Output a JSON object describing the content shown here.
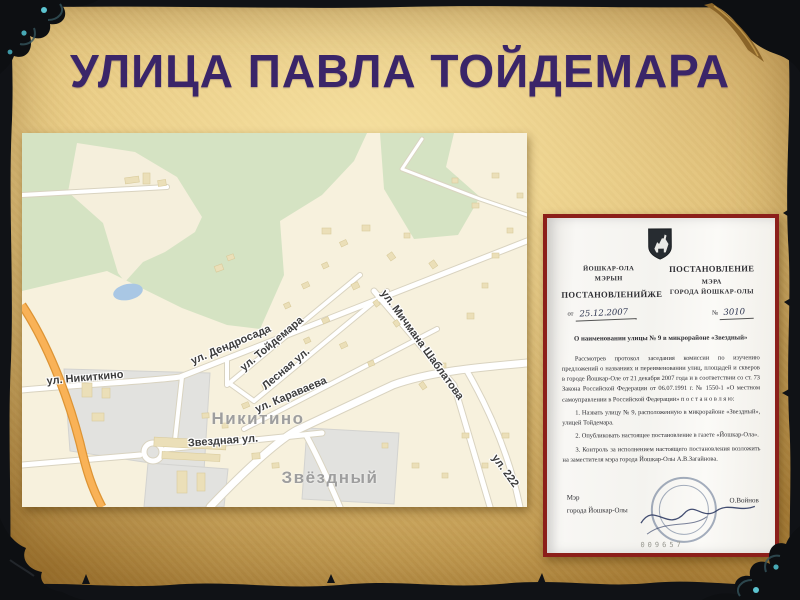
{
  "slide": {
    "title": "УЛИЦА ПАВЛА ТОЙДЕМАРА",
    "title_color": "#3a2569",
    "background": {
      "parchment_center": "#ecd392",
      "parchment_edge": "#b18435",
      "frame": "#0d0f12",
      "ornament_gem": "#53bcc9"
    }
  },
  "map": {
    "streets": [
      "ул. Никиткино",
      "ул. Дендросада",
      "ул. Тойдемара",
      "Лесная ул.",
      "ул. Караваева",
      "ул. Мичмана Шаблатова",
      "Звездная ул.",
      "ул. 222"
    ],
    "places": [
      "Никитино",
      "Звёздный"
    ],
    "colors": {
      "land": "#f7f1dd",
      "green": "#d5e3c3",
      "road": "#ffffff",
      "road_casing": "#d9d3c0",
      "highway": "#f9b257",
      "water": "#a9c7e4",
      "gray_zone": "#e2e2df",
      "building": "#ebdfb8",
      "street_label": "#3c3c3c",
      "place_label": "#9e9e9e"
    }
  },
  "document": {
    "header_left_org1": "ЙОШКАР-ОЛА",
    "header_left_org2": "МЭРЫН",
    "header_left_title": "ПОСТАНОВЛЕНИЙЖЕ",
    "date_prefix": "от",
    "date_value": "25.12.2007",
    "header_right_title": "ПОСТАНОВЛЕНИЕ",
    "header_right_org1": "МЭРА",
    "header_right_org2": "ГОРОДА ЙОШКАР-ОЛЫ",
    "number_prefix": "№",
    "number_value": "3010",
    "subject": "О наименовании улицы № 9 в микрорайоне «Звездный»",
    "body": [
      "Рассмотрев протокол заседания комиссии по изучению предложений о названиях и переименовании улиц, площадей и скверов в городе Йошкар-Оле от 21 декабря 2007 года и в соответствии со ст. 73 Закона Российской Федерации от 06.07.1991 г. № 1550-1 «О местном самоуправлении в Российской Федерации» п о с т а н о в л я ю:",
      "1. Назвать улицу № 9, расположенную в микрорайоне «Звездный», улицей Тойдемара.",
      "2. Опубликовать настоящее постановление в газете «Йошкар-Ола».",
      "3. Контроль за исполнением настоящего постановления возложить на заместителя мэра города Йошкар-Олы А.В.Загайнова."
    ],
    "signer_role_line1": "Мэр",
    "signer_role_line2": "города Йошкар-Олы",
    "signer_name": "О.Войнов",
    "doc_number": "009657"
  }
}
